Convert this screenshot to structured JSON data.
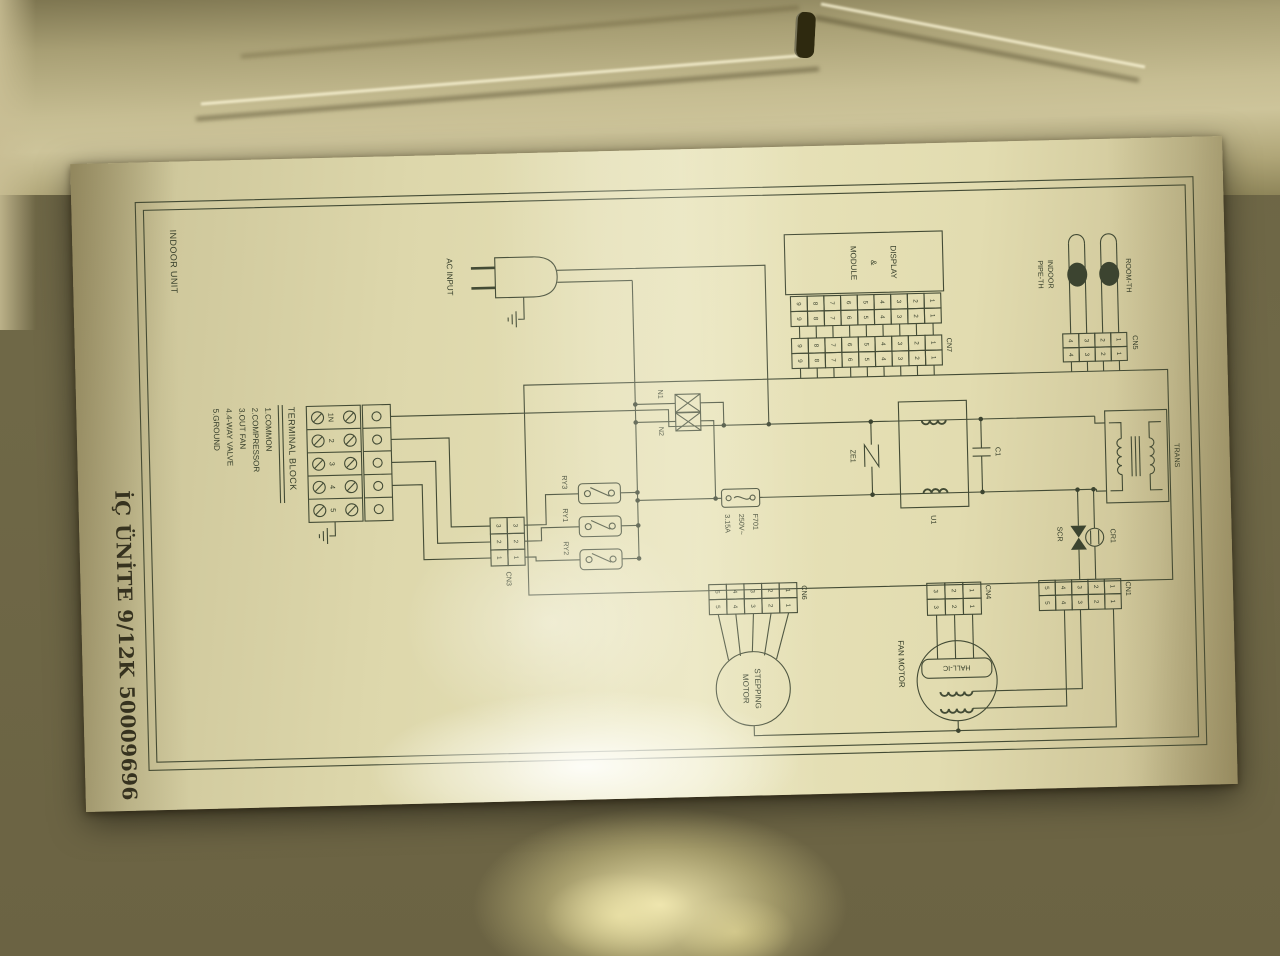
{
  "label": {
    "title": "İÇ ÜNİTE 9/12K 50009696",
    "corner_text": "INDOOR UNIT"
  },
  "schematic": {
    "ac_input_label": "AC INPUT",
    "display_module_lines": [
      "DISPLAY",
      "&",
      "MODULE"
    ],
    "trans_label": "TRANS",
    "fuse": {
      "name": "F701",
      "rating_voltage": "250V~",
      "rating_current": "3.15A"
    },
    "varistor_label": "ZE1",
    "filter_label": "U1",
    "cap_label": "C1",
    "noise_filters": [
      "N1",
      "N2"
    ],
    "relay_labels": [
      "RY3",
      "RY1",
      "RY2"
    ],
    "scr_label": "SCR",
    "cr1_label": "CR1",
    "thermistors": {
      "room": "ROOM-TH",
      "pipe_line1": "INDOOR",
      "pipe_line2": "PIPE-TH"
    },
    "fan_motor_label": "FAN MOTOR",
    "hall_ic_label": "HALL-IC",
    "stepping_motor_lines": [
      "STEPPING",
      "MOTOR"
    ],
    "terminal_block": {
      "heading": "TERMINAL BLOCK",
      "terminals": [
        "1N",
        "2",
        "3",
        "4",
        "5"
      ],
      "legend": [
        "1.COMMON",
        "2.COMPRESSOR",
        "3.OUT FAN",
        "4.4-WAY VALVE",
        "5.GROUND"
      ]
    },
    "connectors": {
      "cn1": {
        "label": "CN1",
        "pins": [
          "1",
          "2",
          "3",
          "4",
          "5"
        ]
      },
      "cn3": {
        "label": "CN3",
        "pins": [
          "3",
          "2",
          "1"
        ]
      },
      "cn4": {
        "label": "CN4",
        "pins": [
          "1",
          "2",
          "3"
        ]
      },
      "cn5": {
        "label": "CN5",
        "pins": [
          "1",
          "2",
          "3",
          "4"
        ]
      },
      "cn6": {
        "label": "CN6",
        "pins": [
          "1",
          "2",
          "3",
          "4",
          "5"
        ]
      },
      "cn7": {
        "label": "CN7",
        "pins": [
          "1",
          "2",
          "3",
          "4",
          "5",
          "6",
          "7",
          "8",
          "9"
        ]
      },
      "disp": {
        "label": "",
        "pins": [
          "1",
          "2",
          "3",
          "4",
          "5",
          "6",
          "7",
          "8",
          "9"
        ]
      }
    }
  },
  "colors": {
    "ink": "#434b35",
    "paper_light": "#e7e2b8",
    "paper_dark": "#a99f74",
    "background_olive": "#6f6847"
  }
}
